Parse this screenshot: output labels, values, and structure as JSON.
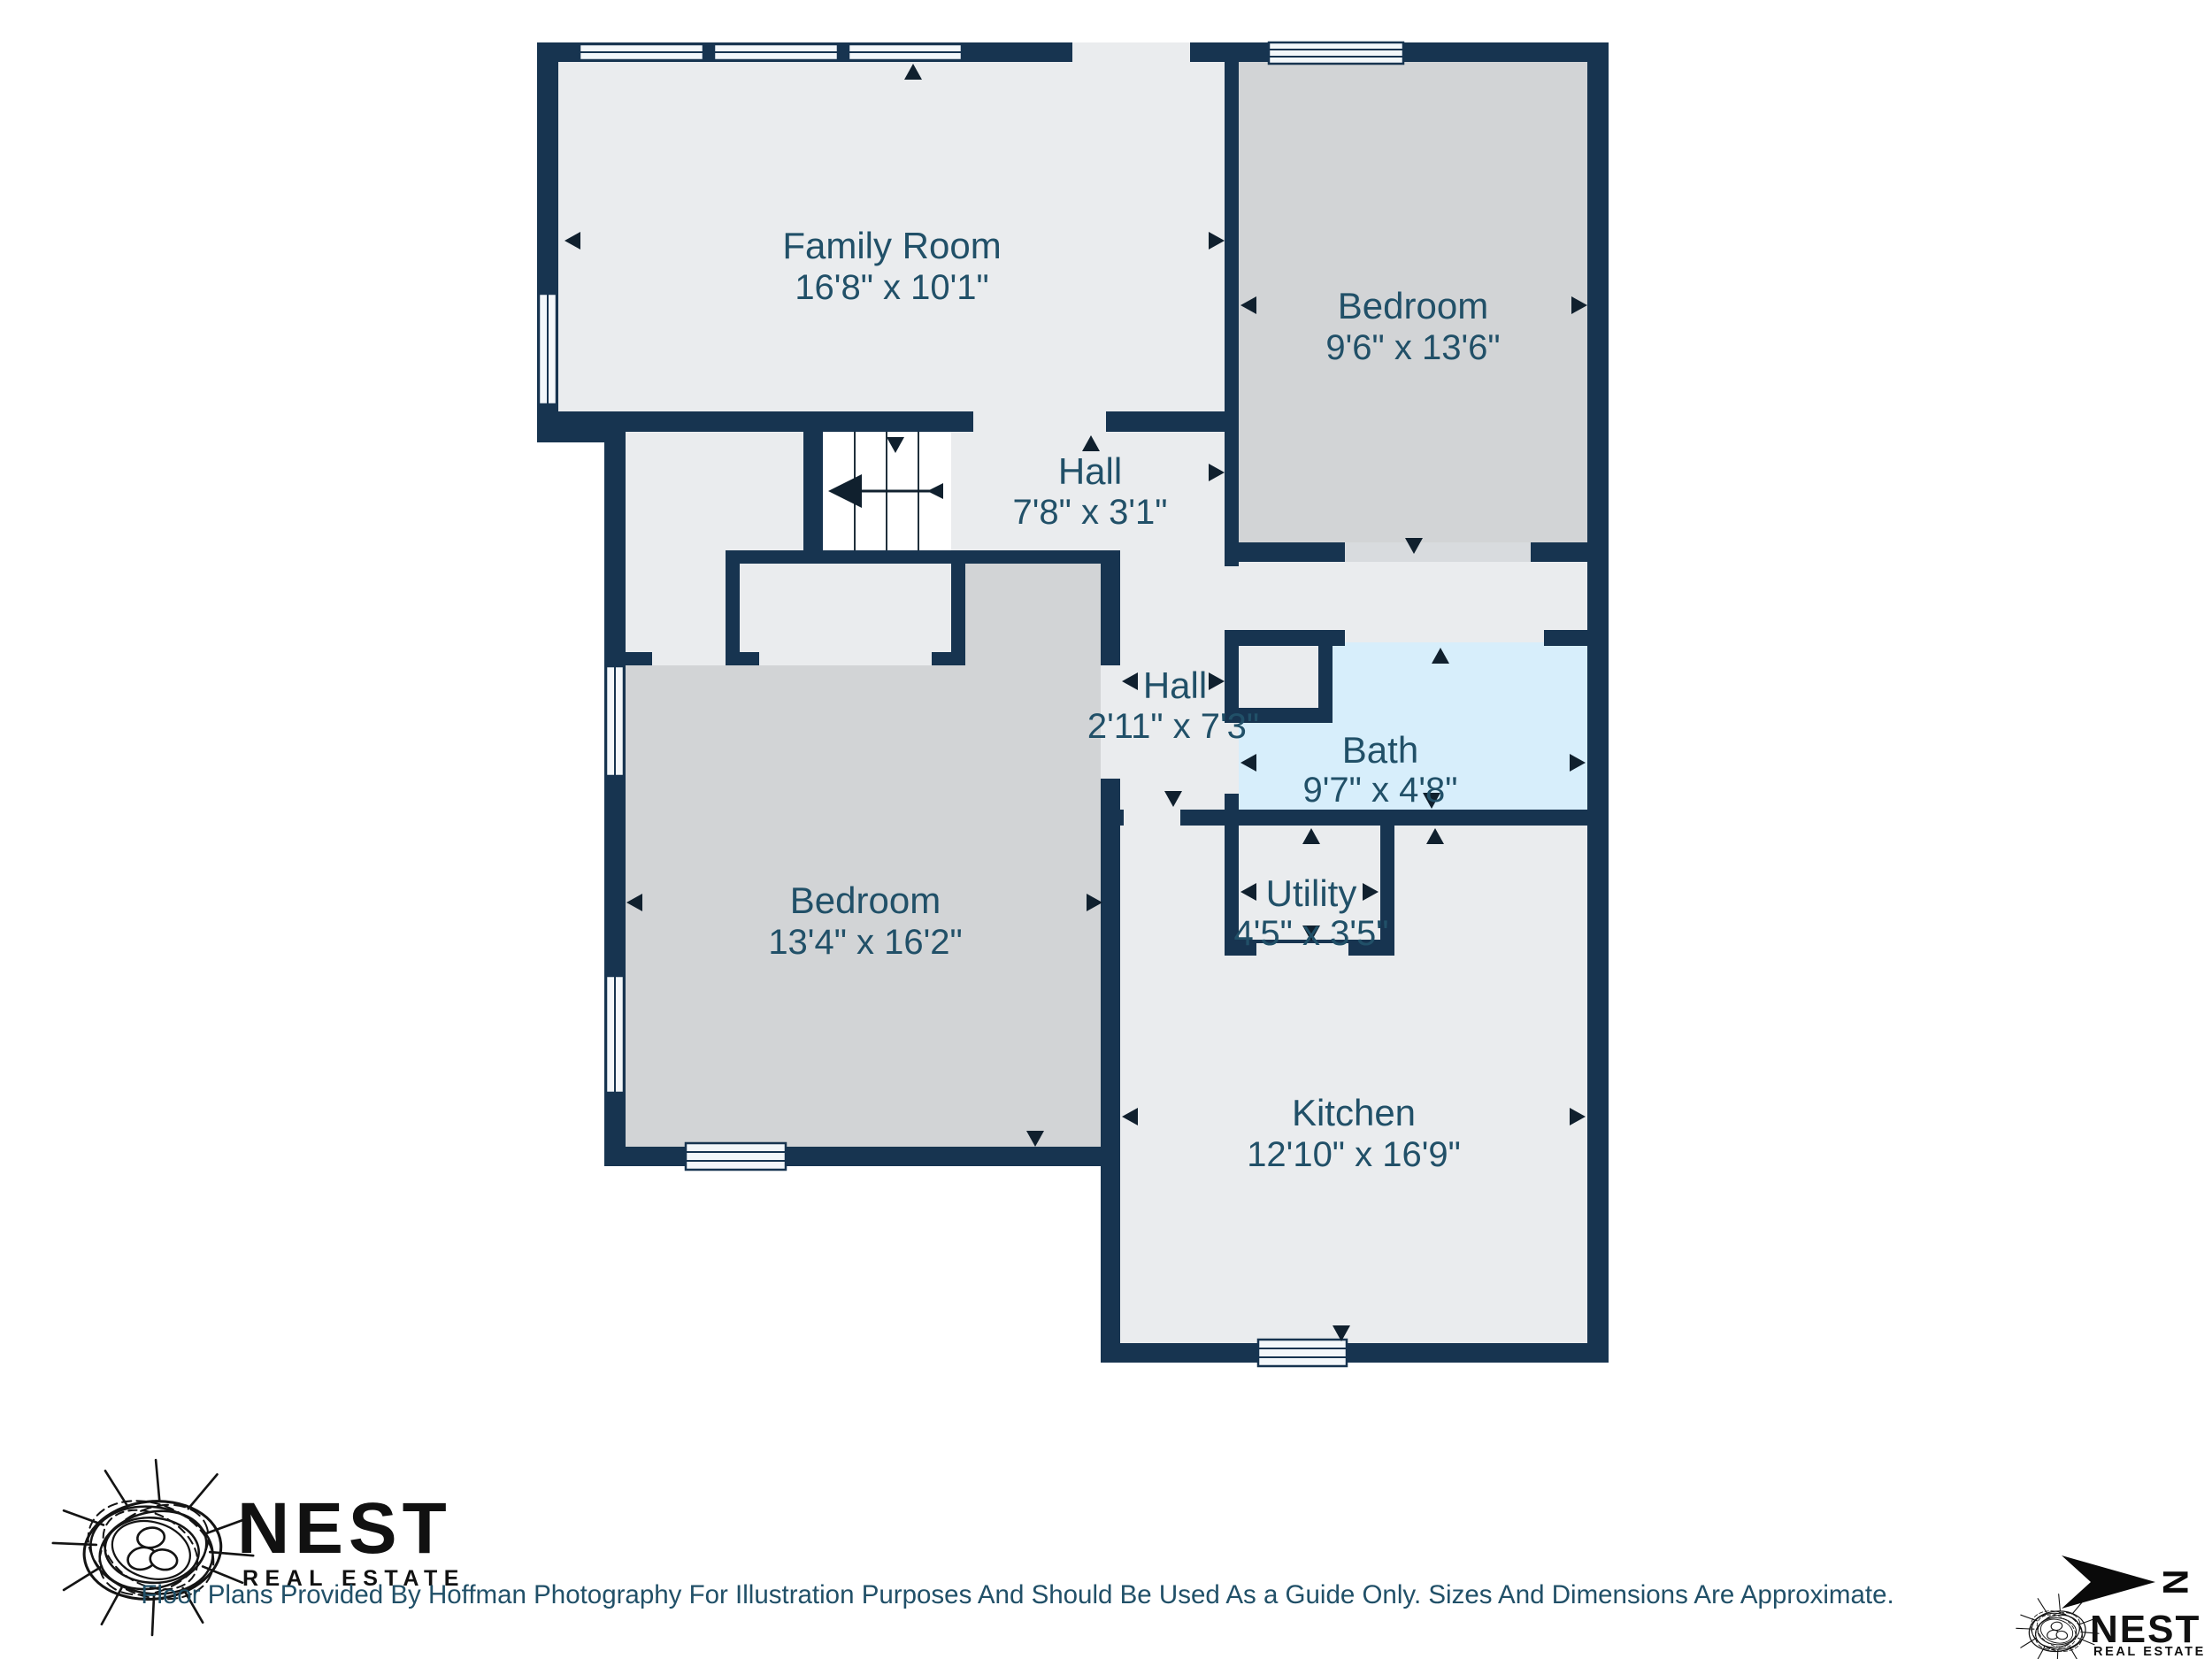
{
  "floorplan": {
    "rooms": [
      {
        "name": "Family Room",
        "dimensions": "16'8\" x 10'1\""
      },
      {
        "name": "Bedroom",
        "dimensions": "9'6\" x 13'6\""
      },
      {
        "name": "Hall",
        "dimensions": "7'8\" x 3'1\""
      },
      {
        "name": "Hall",
        "dimensions": "2'11\" x 7'3\""
      },
      {
        "name": "Bedroom",
        "dimensions": "13'4\" x 16'2\""
      },
      {
        "name": "Bath",
        "dimensions": "9'7\" x 4'8\""
      },
      {
        "name": "Utility",
        "dimensions": "4'5\" x 3'5\""
      },
      {
        "name": "Kitchen",
        "dimensions": "12'10\" x 16'9\""
      }
    ],
    "colors": {
      "wall": "#173450",
      "room_light": "#eaecee",
      "room_dark": "#d2d4d6",
      "bath": "#d7eefb",
      "label": "#215068"
    }
  },
  "branding": {
    "logo_title": "NEST",
    "logo_subtitle": "REAL ESTATE",
    "disclaimer": "Floor Plans Provided By Hoffman Photography For Illustration Purposes And Should Be Used As a Guide Only. Sizes And Dimensions Are Approximate."
  },
  "compass": {
    "north_label": "N"
  }
}
